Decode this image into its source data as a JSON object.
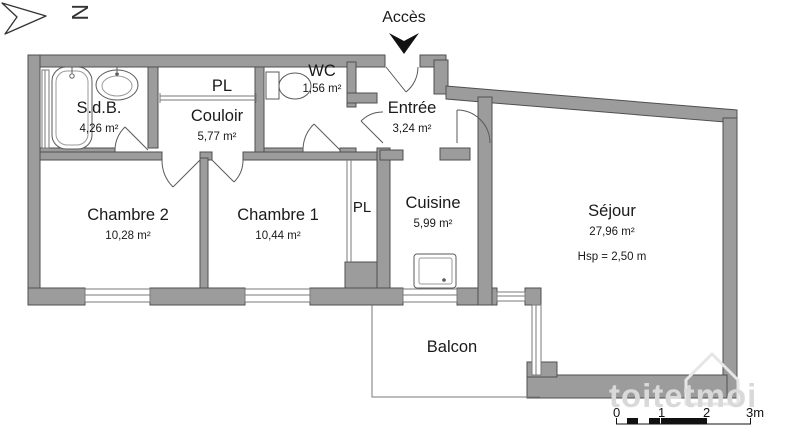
{
  "meta": {
    "north_label": "N",
    "access_label": "Accès"
  },
  "rooms": [
    {
      "id": "sdb",
      "name": "S.d.B.",
      "area": "4,26 m²"
    },
    {
      "id": "pl-top",
      "name": "PL",
      "area": ""
    },
    {
      "id": "wc",
      "name": "WC",
      "area": "1,56 m²"
    },
    {
      "id": "couloir",
      "name": "Couloir",
      "area": "5,77 m²"
    },
    {
      "id": "entree",
      "name": "Entrée",
      "area": "3,24 m²"
    },
    {
      "id": "chambre2",
      "name": "Chambre 2",
      "area": "10,28 m²"
    },
    {
      "id": "chambre1",
      "name": "Chambre 1",
      "area": "10,44 m²"
    },
    {
      "id": "pl-side",
      "name": "PL",
      "area": ""
    },
    {
      "id": "cuisine",
      "name": "Cuisine",
      "area": "5,99 m²"
    },
    {
      "id": "sejour",
      "name": "Séjour",
      "area": "27,96 m²",
      "ceiling_height": "Hsp = 2,50 m"
    },
    {
      "id": "balcon",
      "name": "Balcon",
      "area": ""
    }
  ],
  "scale_bar": {
    "labels": [
      "0",
      "1",
      "2",
      "3m"
    ]
  },
  "watermark": {
    "text": "toitetmoi"
  },
  "colors": {
    "wall_fill": "#9c9c9c",
    "wall_stroke": "#4f4f4f",
    "watermark": "#d9d9d9"
  }
}
